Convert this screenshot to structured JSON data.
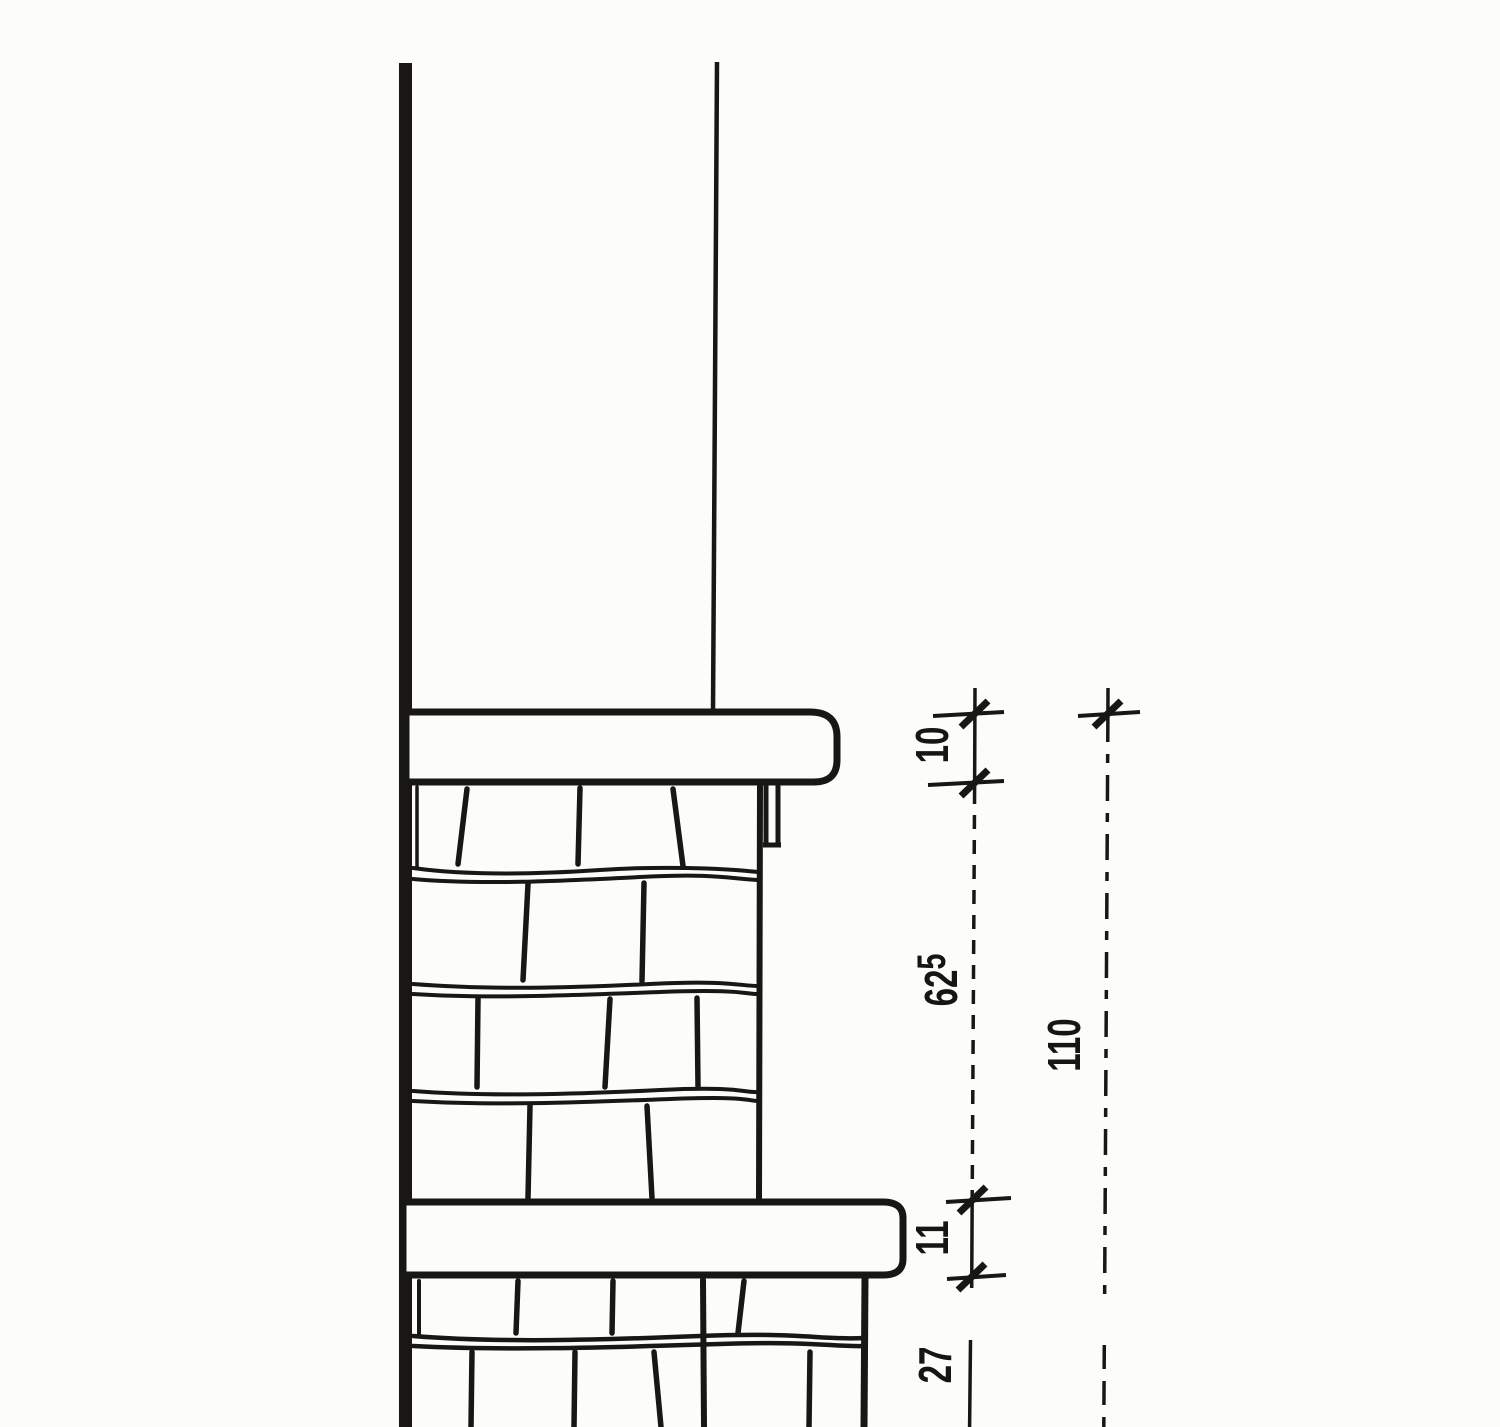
{
  "meta": {
    "drawing_kind": "scanned architectural wall section detail",
    "paper_color": "#fcfcfa",
    "ink_color": "#181715"
  },
  "dimension_chains": {
    "primary": {
      "segments": [
        {
          "value": "10"
        },
        {
          "value": "62",
          "superscript": "5"
        },
        {
          "value": "11"
        },
        {
          "value": "27"
        }
      ]
    },
    "overall": {
      "segments": [
        {
          "value": "110"
        }
      ]
    }
  }
}
